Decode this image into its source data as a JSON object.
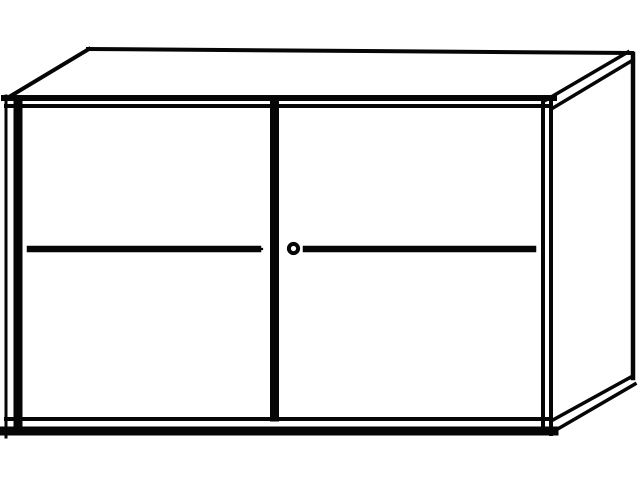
{
  "illustration": {
    "subject": "two-sliding-door-cabinet-line-drawing",
    "background_color": "#ffffff",
    "line_color": "#060606"
  },
  "parts": {
    "body": "cabinet-carcass",
    "left_door": "left-sliding-door",
    "right_door": "right-sliding-door",
    "divider": "center-door-divider",
    "lock": "cylinder-lock",
    "grooves": "handle-groove-centerlines"
  }
}
